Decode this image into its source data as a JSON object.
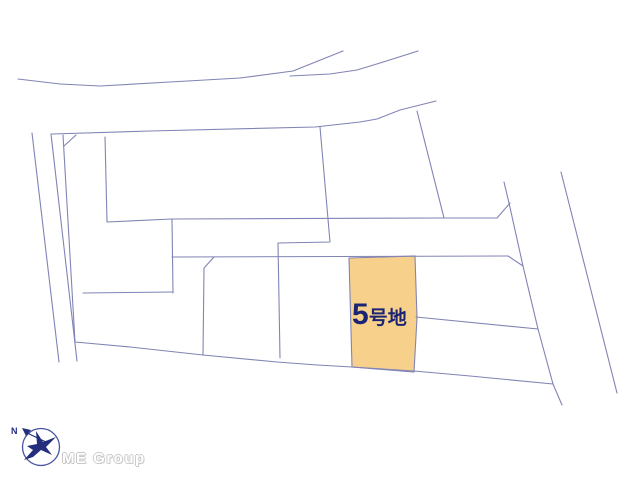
{
  "map": {
    "line_color": "#8184b5",
    "background": "#ffffff",
    "highlight_plot": {
      "label_number": "5",
      "label_suffix": "号地",
      "label_color": "#1b2473",
      "fill": "#f7d18c",
      "points": "349,258 415,256 417,318 414,372 352,367"
    },
    "lines": [
      {
        "name": "top-road-upper-edge",
        "points": "18,79 60,84 100,86 170,82 240,78 293,71 343,51"
      },
      {
        "name": "top-road-lower-branch",
        "points": "290,76 330,74 357,70 380,63 418,51"
      },
      {
        "name": "upper-block-north-edge",
        "points": "52,134 150,131 315,127 360,122 377,119 400,110 420,105 436,101"
      },
      {
        "name": "left-road-west-edge",
        "points": "32,133 59,362"
      },
      {
        "name": "left-road-east-edge",
        "points": "51,134 77,361"
      },
      {
        "name": "left-parcel-west-edge",
        "points": "63,135 75,342"
      },
      {
        "name": "corner-cut-northwest",
        "points": "76,135 64,146"
      },
      {
        "name": "left-parcel-east-upper",
        "points": "105,137 107,222"
      },
      {
        "name": "middle-road-top-edge",
        "points": "107,222 172,219 444,218 497,218"
      },
      {
        "name": "left-parcel-east-lower",
        "points": "172,219 173,293"
      },
      {
        "name": "left-parcel-south-edge",
        "points": "83,293 173,292"
      },
      {
        "name": "large-parcel-east-edge",
        "points": "417,111 444,218"
      },
      {
        "name": "flag-lot-divider",
        "points": "320,127 330,242 278,243 280,358"
      },
      {
        "name": "middle-road-bottom-edge",
        "points": "172,257 508,256"
      },
      {
        "name": "row-divider-west",
        "points": "214,257 204,268 203,355"
      },
      {
        "name": "row-bottom-boundary",
        "points": "75,342 130,347 203,355 277,362 317,365 352,367 414,371 470,376 553,384"
      },
      {
        "name": "row-divider-east-of-5",
        "points": "416,317 538,329"
      },
      {
        "name": "right-road-west-edge",
        "points": "504,182 509,203 523,266 538,329 553,384 562,405"
      },
      {
        "name": "corner-flare-northeast",
        "points": "510,203 497,218"
      },
      {
        "name": "corner-cut-southeast",
        "points": "508,256 523,266"
      },
      {
        "name": "right-road-east-edge",
        "points": "561,172 617,393"
      }
    ]
  },
  "branding": {
    "company": "ME Group",
    "compass_n": "N",
    "logo_color": "#232e7d",
    "ring_color": "#4a55a0",
    "text_color": "#c8c8c8"
  }
}
